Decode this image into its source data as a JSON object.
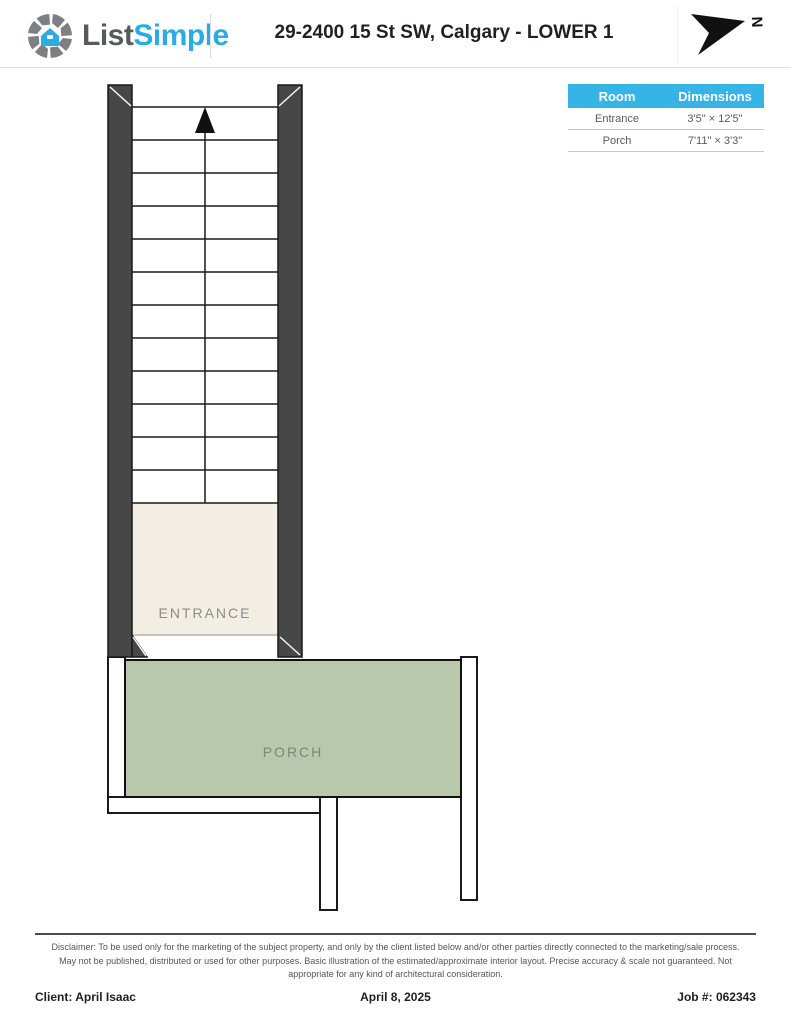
{
  "header": {
    "logo_part1": "List",
    "logo_part2": "Simple",
    "title": "29-2400 15 St SW, Calgary - LOWER 1",
    "compass_label": "N"
  },
  "room_table": {
    "columns": {
      "room": "Room",
      "dimensions": "Dimensions"
    },
    "rows": [
      {
        "room": "Entrance",
        "dimensions": "3'5\" × 12'5\""
      },
      {
        "room": "Porch",
        "dimensions": "7'11\" × 3'3\""
      }
    ]
  },
  "floorplan": {
    "rooms": [
      {
        "label": "ENTRANCE"
      },
      {
        "label": "PORCH"
      }
    ],
    "stair_direction": "up",
    "colors": {
      "wall": "#474747",
      "entrance_floor": "#f3eee4",
      "porch_floor": "#b9c7ad",
      "outline": "#1a1a1a"
    }
  },
  "colors": {
    "accent_table_header": "#35b4e5",
    "logo_gray": "#58595b",
    "logo_blue": "#2aabe2"
  },
  "footer": {
    "disclaimer": "Disclaimer: To be used only for the marketing of the subject property, and only by the client listed below and/or other parties directly connected to the marketing/sale process. May not be published, distributed or used for other purposes. Basic illustration of the estimated/approximate interior layout. Precise accuracy & scale not guaranteed. Not appropriate for any kind of architectural consideration.",
    "client": "Client: April Isaac",
    "date": "April 8, 2025",
    "job": "Job #: 062343"
  }
}
